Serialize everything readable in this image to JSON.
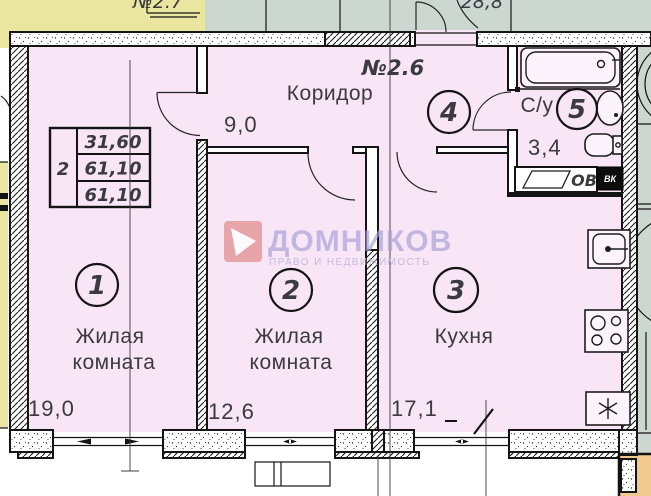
{
  "plan": {
    "apartment_number": "№2.6",
    "neighbor_left_number": "№2.7",
    "neighbor_right_area": "28,8",
    "info_table": {
      "rooms_count": "2",
      "living_area": "31,60",
      "area": "61,10",
      "total_area": "61,10"
    },
    "rooms": [
      {
        "number": "1",
        "name_line1": "Жилая",
        "name_line2": "комната",
        "area": "19,0"
      },
      {
        "number": "2",
        "name_line1": "Жилая",
        "name_line2": "комната",
        "area": "12,6"
      },
      {
        "number": "3",
        "name_line1": "Кухня",
        "name_line2": "",
        "area": "17,1"
      },
      {
        "number": "4",
        "name_line1": "Коридор",
        "name_line2": "",
        "area": "9,0"
      },
      {
        "number": "5",
        "name_line1": "С/у",
        "name_line2": "",
        "area": "3,4"
      }
    ],
    "vent_labels": {
      "ov": "ОВ",
      "vk": "ВК"
    }
  },
  "watermark": {
    "title": "ДОМНИКОВ",
    "subtitle": "ПРАВО И НЕДВИЖИМОСТЬ"
  },
  "colors": {
    "pink": "#f8e5f6",
    "yellow": "#eae69f",
    "grey": "#cdd7d2",
    "orange": "#f2ca90",
    "wall": "#141414",
    "text": "#3a3a40",
    "wmred": "#e59a9c",
    "wmtext": "#a7a0d6",
    "wmsub": "#bdb3d8"
  }
}
